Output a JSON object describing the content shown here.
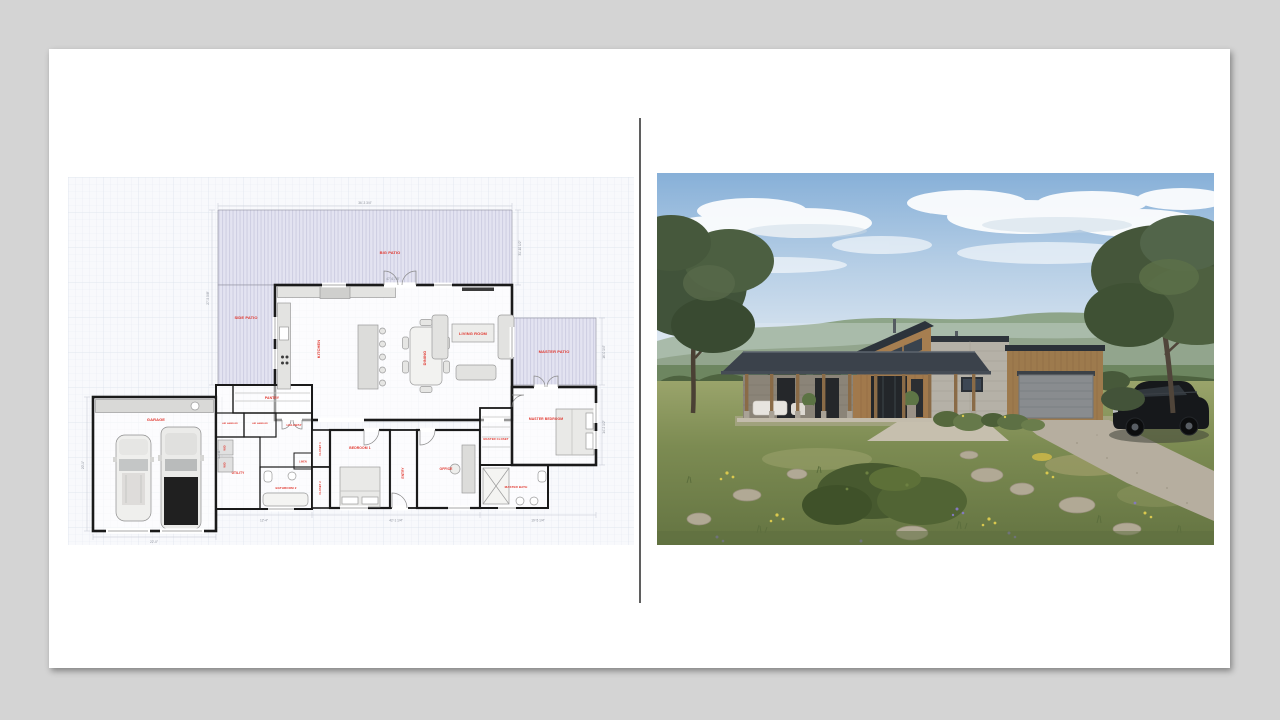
{
  "slide": {
    "background_color": "#d4d4d4",
    "surface_color": "#ffffff",
    "divider_color": "#5f5f5f"
  },
  "floor_plan": {
    "label_color": "#e0342b",
    "wall_color": "#1a1a1a",
    "patio_fill": "#e3e3f1",
    "patio_stripe": "#cfcfe3",
    "grid_color": "#e8ebf2",
    "rooms": [
      {
        "label": "BIG PATIO"
      },
      {
        "label": "SIDE PATIO"
      },
      {
        "label": "MASTER PATIO"
      },
      {
        "label": "KITCHEN"
      },
      {
        "label": "DINING"
      },
      {
        "label": "LIVING ROOM"
      },
      {
        "label": "PANTRY"
      },
      {
        "label": "AIR HANDLER"
      },
      {
        "label": "AIR HANDLER"
      },
      {
        "label": "HALLWAY"
      },
      {
        "label": "W/D"
      },
      {
        "label": "W/D"
      },
      {
        "label": "UTILITY"
      },
      {
        "label": "LINEN"
      },
      {
        "label": "CLOSET 1"
      },
      {
        "label": "BATHROOM 2"
      },
      {
        "label": "CLOSET 2"
      },
      {
        "label": "GARAGE"
      },
      {
        "label": "BEDROOM 1"
      },
      {
        "label": "ENTRY"
      },
      {
        "label": "OFFICE"
      },
      {
        "label": "MASTER CLOSET"
      },
      {
        "label": "MASTER BATH"
      },
      {
        "label": "MASTER BEDROOM"
      }
    ],
    "dimensions": [
      "36'-3 3/4\"",
      "27'-5 5/8\"",
      "31'-10 1/2\"",
      "16'-0 1/4\"",
      "14'-2 1/2\"",
      "22'-0\"",
      "42'-1 1/4\"",
      "19'-5 1/4\"",
      "20'-1\"",
      "12'-4\"",
      "47'-6 7/8\"",
      "10'-11\""
    ]
  },
  "photo": {
    "palette": {
      "sky_top": "#87b0d8",
      "sky_horizon": "#e8eef4",
      "hills": "#6d8660",
      "meadow": "#7c8b52",
      "wood_siding": "#9d7a4d",
      "concrete": "#b5b1a7",
      "roof": "#3b424b",
      "garage_door": "#898c8f",
      "suv": "#16181b"
    }
  }
}
